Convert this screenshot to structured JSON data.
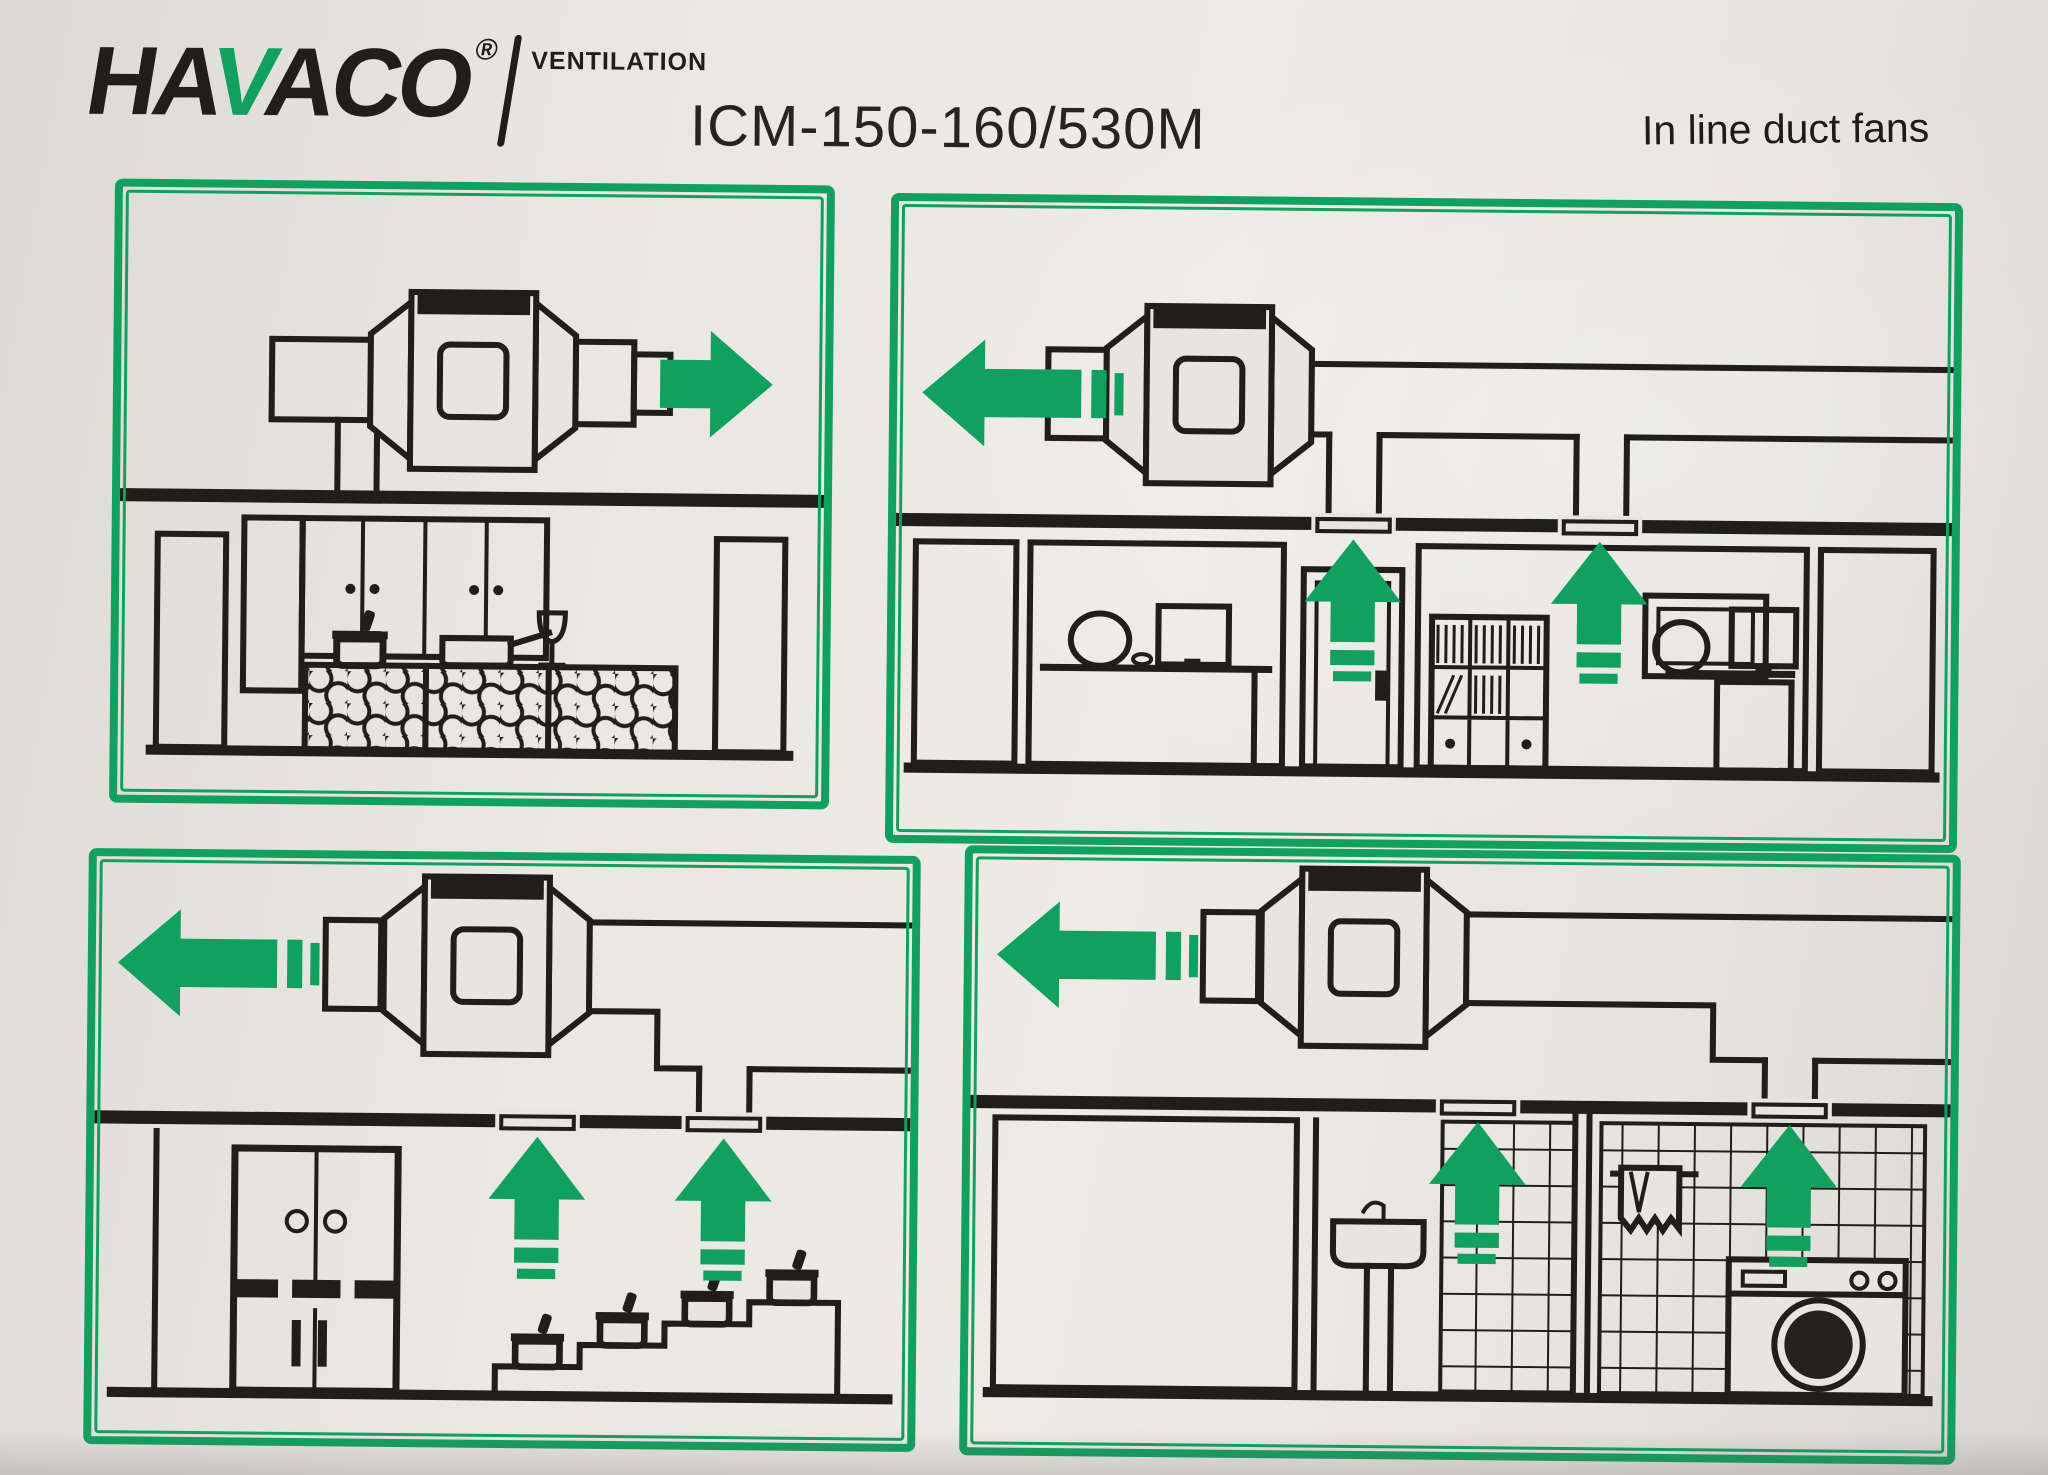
{
  "header": {
    "brand": {
      "part1": "HA",
      "accent_letter": "V",
      "part2": "ACO",
      "registered": "®",
      "division": "VENTILATION"
    },
    "model": "ICM-150-160/530M",
    "tagline": "In line duct fans"
  },
  "colors": {
    "accent_green": "#12a05f",
    "line_ink": "#201e1b",
    "paper": "#e8e5e0"
  },
  "panels": [
    {
      "name": "kitchen-exhaust",
      "scene": "domestic kitchen with pots and honeycomb counter",
      "airflow_direction": "right",
      "ceiling_vents": 0
    },
    {
      "name": "offices-exhaust",
      "scene": "two office rooms, door vent and ceiling vents",
      "airflow_direction": "left",
      "ceiling_vents": 2
    },
    {
      "name": "catering-kitchen-exhaust",
      "scene": "commercial kitchen, cold cabinet and stepped serving counter with pots",
      "airflow_direction": "left",
      "ceiling_vents": 2
    },
    {
      "name": "bathroom-laundry-exhaust",
      "scene": "bathroom with basin and tiled laundry with washing machine",
      "airflow_direction": "left",
      "ceiling_vents": 2
    }
  ]
}
